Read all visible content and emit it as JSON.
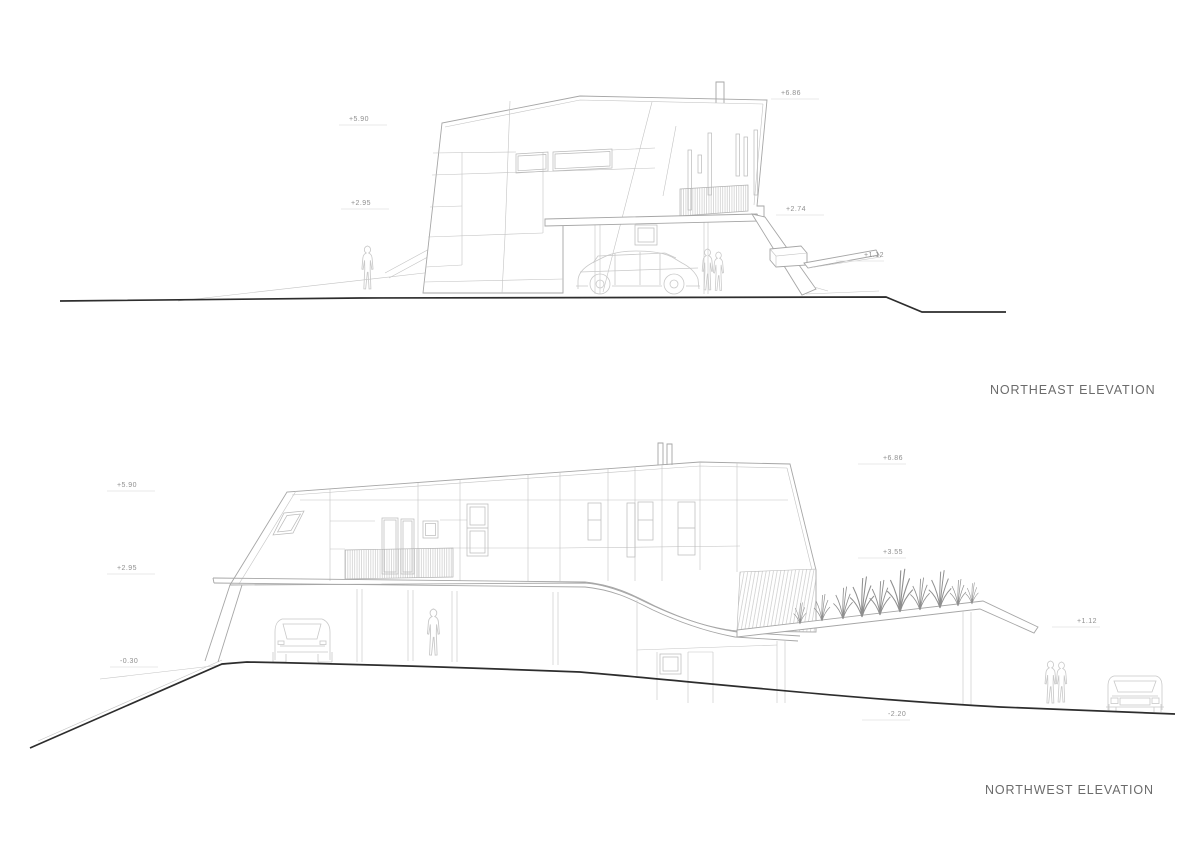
{
  "canvas": {
    "width": 1191,
    "height": 842,
    "background": "#ffffff",
    "line_color": "#a6a6a6",
    "ground_color": "#2d2d2d",
    "label_color": "#8f8f8f",
    "title_color": "#6b6b6b"
  },
  "drawings": [
    {
      "name": "northeast-elevation",
      "title": "NORTHEAST ELEVATION",
      "markers": [
        {
          "label": "+5.90"
        },
        {
          "label": "+2.95"
        },
        {
          "label": "+6.86"
        },
        {
          "label": "+2.74"
        },
        {
          "label": "+1.12"
        }
      ]
    },
    {
      "name": "northwest-elevation",
      "title": "NORTHWEST ELEVATION",
      "markers": [
        {
          "label": "+5.90"
        },
        {
          "label": "+2.95"
        },
        {
          "label": "-0.30"
        },
        {
          "label": "+6.86"
        },
        {
          "label": "+3.55"
        },
        {
          "label": "+1.12"
        },
        {
          "label": "-2.20"
        }
      ]
    }
  ]
}
